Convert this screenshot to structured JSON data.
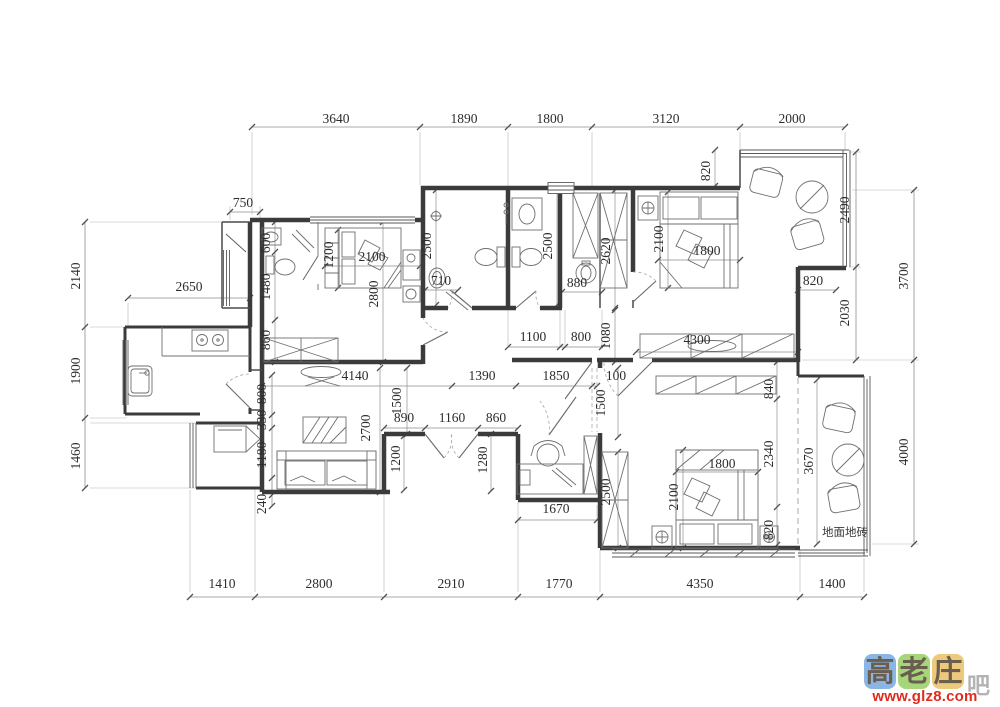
{
  "drawing": {
    "floor_note": "地面地砖",
    "labels": [
      {
        "t": "3640",
        "x": 336,
        "y": 123
      },
      {
        "t": "1890",
        "x": 464,
        "y": 123
      },
      {
        "t": "1800",
        "x": 550,
        "y": 123
      },
      {
        "t": "3120",
        "x": 666,
        "y": 123
      },
      {
        "t": "2000",
        "x": 792,
        "y": 123
      },
      {
        "t": "1410",
        "x": 222,
        "y": 588
      },
      {
        "t": "2800",
        "x": 319,
        "y": 588
      },
      {
        "t": "2910",
        "x": 451,
        "y": 588
      },
      {
        "t": "1770",
        "x": 559,
        "y": 588
      },
      {
        "t": "4350",
        "x": 700,
        "y": 588
      },
      {
        "t": "1400",
        "x": 832,
        "y": 588
      },
      {
        "t": "2140",
        "x": 80,
        "y": 276,
        "v": true
      },
      {
        "t": "1900",
        "x": 80,
        "y": 371,
        "v": true
      },
      {
        "t": "1460",
        "x": 80,
        "y": 456,
        "v": true
      },
      {
        "t": "750",
        "x": 243,
        "y": 207
      },
      {
        "t": "2650",
        "x": 189,
        "y": 291
      },
      {
        "t": "2490",
        "x": 849,
        "y": 210,
        "v": true
      },
      {
        "t": "2030",
        "x": 849,
        "y": 313,
        "v": true
      },
      {
        "t": "3700",
        "x": 908,
        "y": 276,
        "v": true
      },
      {
        "t": "4000",
        "x": 908,
        "y": 452,
        "v": true
      },
      {
        "t": "600",
        "x": 270,
        "y": 243,
        "v": true
      },
      {
        "t": "1480",
        "x": 270,
        "y": 287,
        "v": true
      },
      {
        "t": "860",
        "x": 270,
        "y": 340,
        "v": true
      },
      {
        "t": "1200",
        "x": 333,
        "y": 255,
        "v": true
      },
      {
        "t": "2100",
        "x": 372,
        "y": 261
      },
      {
        "t": "2800",
        "x": 378,
        "y": 294,
        "v": true
      },
      {
        "t": "2500",
        "x": 431,
        "y": 246,
        "v": true
      },
      {
        "t": "710",
        "x": 441,
        "y": 285
      },
      {
        "t": "2500",
        "x": 552,
        "y": 246,
        "v": true
      },
      {
        "t": "2620",
        "x": 610,
        "y": 251,
        "v": true
      },
      {
        "t": "880",
        "x": 577,
        "y": 287
      },
      {
        "t": "1100",
        "x": 533,
        "y": 341
      },
      {
        "t": "800",
        "x": 581,
        "y": 341
      },
      {
        "t": "1080",
        "x": 610,
        "y": 336,
        "v": true
      },
      {
        "t": "820",
        "x": 710,
        "y": 171,
        "v": true
      },
      {
        "t": "2100",
        "x": 663,
        "y": 239,
        "v": true
      },
      {
        "t": "1800",
        "x": 707,
        "y": 255
      },
      {
        "t": "820",
        "x": 813,
        "y": 285
      },
      {
        "t": "4300",
        "x": 697,
        "y": 344
      },
      {
        "t": "4140",
        "x": 355,
        "y": 380
      },
      {
        "t": "1390",
        "x": 482,
        "y": 380
      },
      {
        "t": "1850",
        "x": 556,
        "y": 380
      },
      {
        "t": "100",
        "x": 616,
        "y": 380
      },
      {
        "t": "1500",
        "x": 605,
        "y": 403,
        "v": true
      },
      {
        "t": "800",
        "x": 266,
        "y": 394,
        "v": true
      },
      {
        "t": "330",
        "x": 266,
        "y": 420,
        "v": true
      },
      {
        "t": "1180",
        "x": 266,
        "y": 455,
        "v": true
      },
      {
        "t": "240",
        "x": 266,
        "y": 504,
        "v": true
      },
      {
        "t": "2700",
        "x": 370,
        "y": 428,
        "v": true
      },
      {
        "t": "1500",
        "x": 401,
        "y": 401,
        "v": true
      },
      {
        "t": "890",
        "x": 404,
        "y": 422
      },
      {
        "t": "1160",
        "x": 452,
        "y": 422
      },
      {
        "t": "860",
        "x": 496,
        "y": 422
      },
      {
        "t": "1200",
        "x": 400,
        "y": 459,
        "v": true
      },
      {
        "t": "1280",
        "x": 487,
        "y": 460,
        "v": true
      },
      {
        "t": "1670",
        "x": 556,
        "y": 513
      },
      {
        "t": "2500",
        "x": 610,
        "y": 492,
        "v": true
      },
      {
        "t": "2100",
        "x": 678,
        "y": 497,
        "v": true
      },
      {
        "t": "1800",
        "x": 722,
        "y": 468
      },
      {
        "t": "840",
        "x": 773,
        "y": 389,
        "v": true
      },
      {
        "t": "2340",
        "x": 773,
        "y": 454,
        "v": true
      },
      {
        "t": "820",
        "x": 773,
        "y": 530,
        "v": true
      },
      {
        "t": "3670",
        "x": 813,
        "y": 461,
        "v": true
      },
      {
        "t": "地面地砖",
        "x": 845,
        "y": 536,
        "cn": true
      }
    ]
  },
  "watermark": {
    "tiles": [
      {
        "char": "高",
        "bg": "#8ab5e5"
      },
      {
        "char": "老",
        "bg": "#a6d679"
      },
      {
        "char": "庄",
        "bg": "#edc97c"
      }
    ],
    "suffix": "吧",
    "url": "www.glz8.com",
    "colors": {
      "ink": "#6a5e4e",
      "url": "#e02b1f"
    }
  }
}
